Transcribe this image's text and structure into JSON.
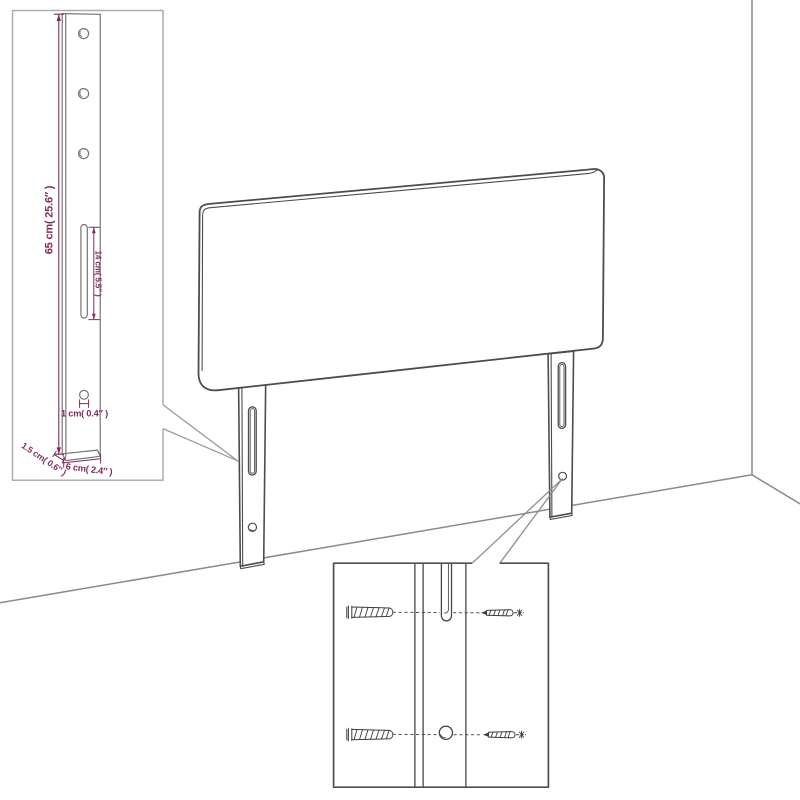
{
  "diagram": {
    "type": "furniture-assembly-dimension-diagram",
    "subject": "upholstered headboard with two mounting legs standing against a wall corner",
    "colors": {
      "background": "#ffffff",
      "outline": "#4c4c4c",
      "dimension": "#7e2c5e",
      "detail_border_light": "#adadad",
      "detail_border_dark": "#4f4f4f",
      "wall_line": "#8a8a8a"
    },
    "detail_top_left": {
      "name": "leg-dimension-callout",
      "dimensions": {
        "leg_height": "65 cm( 25.6″ )",
        "slot_length": "14 cm( 5.5″ )",
        "hole_diameter": "1 cm( 0.4″ )",
        "leg_thickness": "1.5 cm( 0.6″ )",
        "leg_width": "6 cm( 2.4″ )"
      },
      "parts": [
        "mounting-leg",
        "three-screw-holes",
        "adjustment-slot",
        "bottom-hole"
      ]
    },
    "detail_bottom": {
      "name": "wall-fixing-callout",
      "parts": [
        "wall-plug",
        "screw",
        "leg-slot",
        "leg-hole"
      ]
    },
    "main_view": {
      "parts": [
        "headboard-panel",
        "left-leg",
        "right-leg",
        "wall-corner",
        "floor"
      ]
    }
  }
}
